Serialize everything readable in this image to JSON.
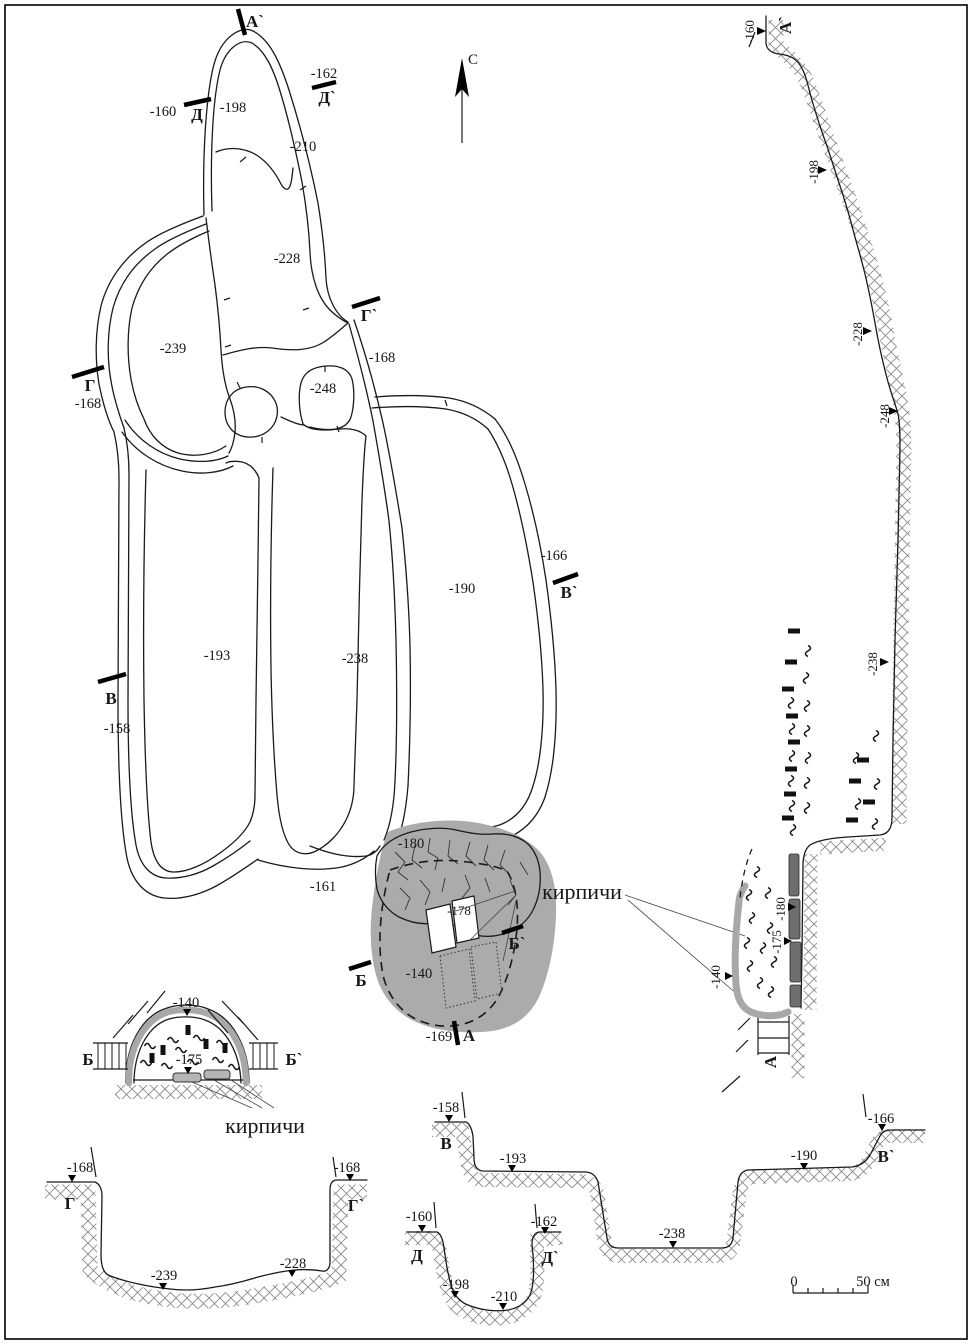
{
  "north": {
    "label": "С"
  },
  "plan": {
    "markers": {
      "a_top": "А`",
      "d": "Д",
      "d_prime": "Д`",
      "g": "Г",
      "g_prime": "Г`",
      "v": "В",
      "v_prime": "В`",
      "b": "Б",
      "b_prime": "Б`",
      "a_bottom": "А"
    },
    "depths": {
      "top_left_surface": "-160",
      "top_right_surface": "-162",
      "lobe_top": "-198",
      "lobe_top_inner": "-210",
      "column": "-228",
      "left_lobe": "-239",
      "pit_248": "-248",
      "g_surface": "-168",
      "g_prime_surface": "-168",
      "trench_left": "-193",
      "trench_mid": "-238",
      "trench_right": "-190",
      "v_surface": "-158",
      "v_prime_surface": "-166",
      "corridor": "-161",
      "oven_top": "-180",
      "oven_brick": "-178",
      "oven_floor": "-140",
      "a_surface": "-169"
    },
    "bricks_label": "кирпичи"
  },
  "profile": {
    "marker_top": "А`",
    "marker_bottom": "А",
    "depths": {
      "surface": "-160",
      "d198": "-198",
      "d228": "-228",
      "d248": "-248",
      "d238": "-238",
      "oven_top": "-180",
      "oven_mid": "-175",
      "oven_floor": "-140"
    }
  },
  "section_b": {
    "marker_left": "Б",
    "marker_right": "Б`",
    "depth_top": "-140",
    "depth_floor": "-175",
    "caption": "кирпичи"
  },
  "section_g": {
    "marker_left": "Г",
    "marker_right": "Г`",
    "depth_left": "-168",
    "depth_right": "-168",
    "depth_bottom_1": "-239",
    "depth_bottom_2": "-228"
  },
  "section_v": {
    "marker_left": "В",
    "marker_right": "В`",
    "depth_left": "-158",
    "depth_right": "-166",
    "depth_step_1": "-193",
    "depth_step_2": "-238",
    "depth_step_3": "-190"
  },
  "section_d": {
    "marker_left": "Д",
    "marker_right": "Д`",
    "depth_left": "-160",
    "depth_right": "-162",
    "depth_bottom_1": "-198",
    "depth_bottom_2": "-210"
  },
  "scale": {
    "zero": "0",
    "end": "50 см"
  }
}
